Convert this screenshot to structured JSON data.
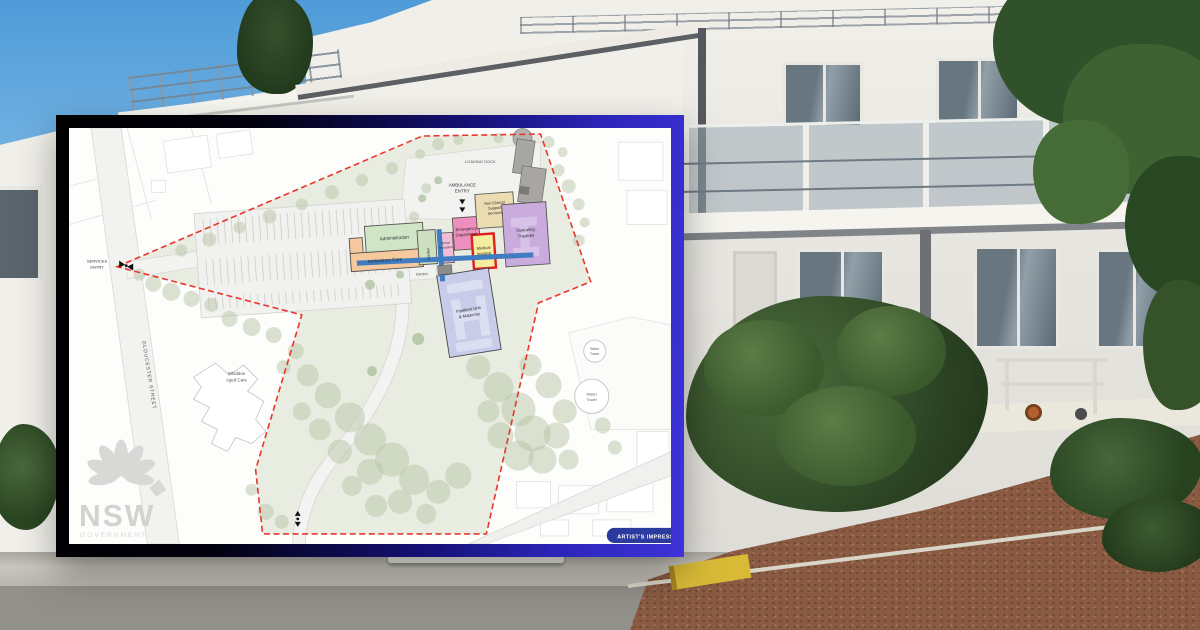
{
  "card": {
    "badge_label": "ARTIST'S IMPRESSION",
    "logo": {
      "acronym": "NSW",
      "government": "GOVERNMENT"
    },
    "frame": {
      "gradient_start": "#000000",
      "gradient_end": "#3d33d9"
    }
  },
  "plan": {
    "street": "GLOUCESTER STREET",
    "annotations": {
      "loading_dock": "LOADING DOCK",
      "ambulance_l1": "AMBULANCE",
      "ambulance_l2": "ENTRY",
      "services_l1": "SERVICES",
      "services_l2": "ENTRY",
      "building_entry": "ENTRY",
      "aged_care_l1": "Whiddon",
      "aged_care_l2": "Aged Care",
      "water_small_l1": "Water",
      "water_small_l2": "Tower",
      "water_large_l1": "Water",
      "water_large_l2": "Tower"
    },
    "buildings": {
      "administration": "Administration",
      "ambulatory": "Ambulatory Care",
      "garden": "Garden",
      "arrival_l1": "Arrival",
      "arrival_l2": "Reception",
      "emergency_l1": "Emergency",
      "emergency_l2": "Department",
      "imaging_l1": "Medical",
      "imaging_l2": "Imaging",
      "nonclinical_l1": "Non Clinical",
      "nonclinical_l2": "Support",
      "nonclinical_l3": "Services",
      "theatres_l1": "Operating",
      "theatres_l2": "Theatres",
      "inpatient_l1": "Inpatient Unit",
      "inpatient_l2": "& Maternity"
    },
    "colors": {
      "boundary": "#e8372c",
      "corridor": "#3f7cc1",
      "administration": "#cfe5c6",
      "ambulatory": "#f6c89e",
      "garden": "#cfe0c0",
      "arrival": "#f3bcd6",
      "emergency": "#ee8fc0",
      "imaging": "#f5ee9e",
      "nonclinical": "#ecdcb2",
      "theatres": "#c9abdd",
      "inpatient": "#c9cce9",
      "badge_bg": "#2b3a9f"
    }
  }
}
